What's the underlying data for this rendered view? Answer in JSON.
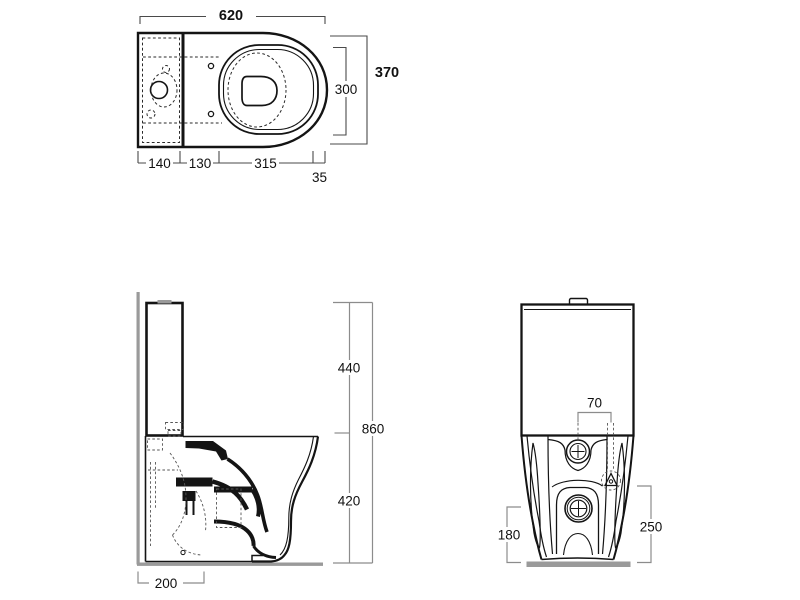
{
  "views": {
    "top": {
      "dims": {
        "total_width": "620",
        "total_depth": "370",
        "bowl_width": "300",
        "tank_depth": "140",
        "mid_segment": "130",
        "seat_length": "315",
        "front_rim": "35"
      }
    },
    "side": {
      "dims": {
        "upper_height": "440",
        "total_height": "860",
        "bowl_height": "420",
        "outlet_depth": "200"
      }
    },
    "front": {
      "dims": {
        "inlet_offset": "70",
        "left_height": "180",
        "right_height": "250"
      }
    }
  },
  "colors": {
    "drawing_line": "#141414",
    "dimension_line": "#8c8c8c",
    "wall_floor": "#9a9a9a",
    "background": "#ffffff"
  }
}
